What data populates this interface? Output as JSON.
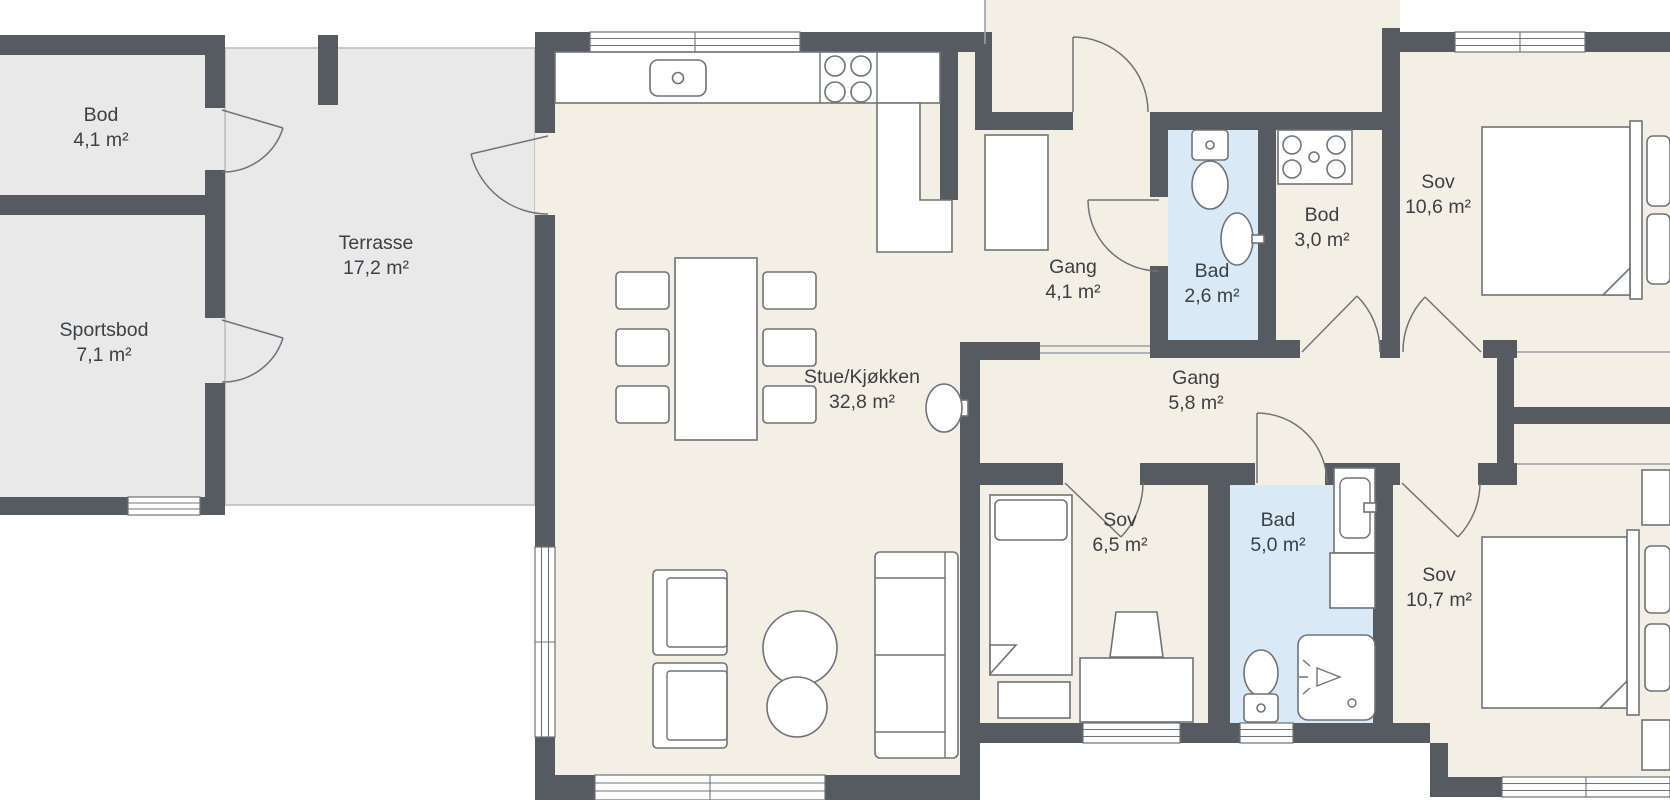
{
  "colors": {
    "wall": "#565a61",
    "floor": "#f4efe5",
    "bathroom_floor": "#d9eaf6",
    "outdoor_floor": "#e9e9e9",
    "background": "#ffffff",
    "furniture_outline": "#6f7377",
    "text": "#3c3f44"
  },
  "rooms": {
    "bod_outbuilding": {
      "name": "Bod",
      "area": "4,1 m²"
    },
    "sportsbod": {
      "name": "Sportsbod",
      "area": "7,1 m²"
    },
    "terrasse": {
      "name": "Terrasse",
      "area": "17,2 m²"
    },
    "stue_kjokken": {
      "name": "Stue/Kjøkken",
      "area": "32,8 m²"
    },
    "gang_entry": {
      "name": "Gang",
      "area": "4,1 m²"
    },
    "bad_small": {
      "name": "Bad",
      "area": "2,6 m²"
    },
    "bod_inner": {
      "name": "Bod",
      "area": "3,0 m²"
    },
    "sov_ne": {
      "name": "Sov",
      "area": "10,6 m²"
    },
    "gang_hall": {
      "name": "Gang",
      "area": "5,8 m²"
    },
    "sov_mid": {
      "name": "Sov",
      "area": "6,5 m²"
    },
    "bad_large": {
      "name": "Bad",
      "area": "5,0 m²"
    },
    "sov_se": {
      "name": "Sov",
      "area": "10,7 m²"
    }
  },
  "fixtures": [
    "kitchen-sink-icon",
    "cooktop-icon",
    "kitchen-counter-icon",
    "dining-table-icon",
    "dining-chair-icon",
    "fireplace-stove-icon",
    "armchair-icon",
    "coffee-table-icon",
    "sofa-icon",
    "wardrobe-icon",
    "single-bed-icon",
    "desk-icon",
    "desk-chair-icon",
    "toilet-icon",
    "wash-basin-icon",
    "washing-machine-icon",
    "shower-icon",
    "bathroom-cabinet-icon",
    "appliance-icon",
    "double-bed-icon",
    "nightstand-icon",
    "closet-icon",
    "door-swing-icon",
    "window-icon"
  ]
}
